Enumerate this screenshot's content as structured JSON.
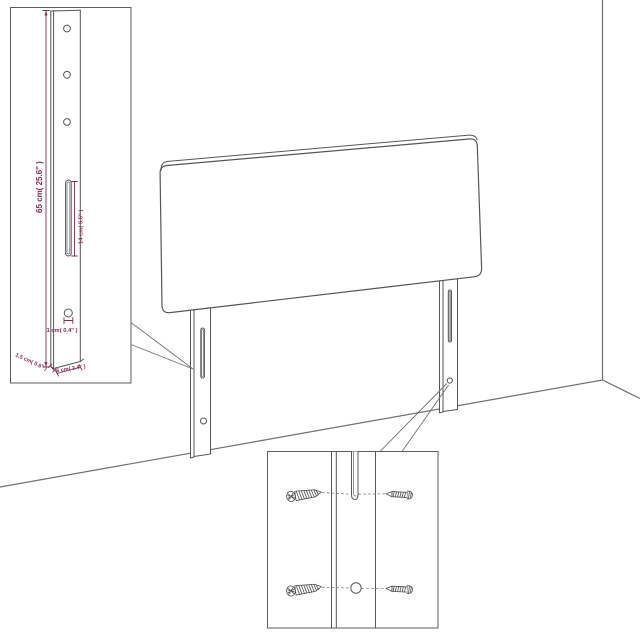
{
  "diagram": {
    "product": "headboard-with-adjustable-legs",
    "colors": {
      "line_art": "#565656",
      "dimension_accent": "#7c2f55",
      "background": "#ffffff"
    },
    "dimensions": {
      "leg_height": "65 cm( 25.6\" )",
      "slot_length": "14 cm( 5.5\" )",
      "hole_diameter": "1 cm( 0.4\" )",
      "leg_depth": "1.5 cm( 0.6\" )",
      "leg_width": "6 cm( 2.4\" )"
    },
    "icons": [
      "phillips-screw-icon",
      "side-screw-icon"
    ]
  }
}
